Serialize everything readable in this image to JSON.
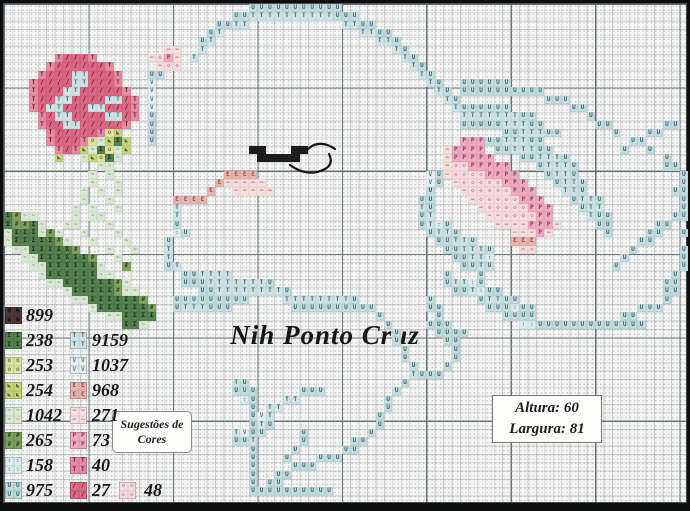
{
  "meta": {
    "kind": "cross-stitch-pattern",
    "grid_columns": 81,
    "grid_rows": 60
  },
  "watermark": {
    "text": "Nih Ponto Cruz"
  },
  "suggestion_box": {
    "line1": "Sugestões de",
    "line2": "Cores"
  },
  "size_box": {
    "altura_label": "Altura:",
    "altura_value": "60",
    "largura_label": "Largura:",
    "largura_value": "81"
  },
  "legend": {
    "left": [
      {
        "code": "899",
        "char": "M"
      },
      {
        "code": "238",
        "char": "D"
      },
      {
        "code": "253",
        "char": "l"
      },
      {
        "code": "254",
        "char": "y"
      },
      {
        "code": "1042",
        "char": "g"
      },
      {
        "code": "265",
        "char": "G"
      },
      {
        "code": "158",
        "char": ":"
      },
      {
        "code": "975",
        "char": "U"
      }
    ],
    "right": [
      {
        "code": "9159",
        "char": "T"
      },
      {
        "code": "1037",
        "char": "V"
      },
      {
        "code": "968",
        "char": "E"
      },
      {
        "code": "271",
        "char": "-"
      },
      {
        "code": "73",
        "char": "P"
      },
      {
        "code": "40",
        "char": "r"
      },
      {
        "code": "27",
        "char": "R"
      }
    ],
    "extra": {
      "code": "48",
      "char": "d"
    }
  },
  "pattern": {
    "palette": {
      "R": {
        "code": "27",
        "color": "#dd6785",
        "symbol": "/",
        "symbol_color": "#5a1a28"
      },
      "r": {
        "code": "40",
        "color": "#e78aa4",
        "symbol": "T",
        "symbol_color": "#6a2035"
      },
      "P": {
        "code": "73",
        "color": "#f0a9c0",
        "symbol": "P",
        "symbol_color": "#8a3a55"
      },
      "d": {
        "code": "48",
        "color": "#f6dbe0",
        "symbol": "◇",
        "symbol_color": "#b06a80"
      },
      "-": {
        "code": "271",
        "color": "#f5dede",
        "symbol": "–",
        "symbol_color": "#a06868"
      },
      "E": {
        "code": "968",
        "color": "#e9b3ae",
        "symbol": "Ɛ",
        "symbol_color": "#8a4a45"
      },
      "M": {
        "code": "899",
        "color": "#4d3838",
        "symbol": "▦",
        "symbol_color": "#1f1414"
      },
      "D": {
        "code": "238",
        "color": "#55814f",
        "symbol": "Σ",
        "symbol_color": "#17301c"
      },
      "G": {
        "code": "265",
        "color": "#7fa05f",
        "symbol": "#",
        "symbol_color": "#2c431f"
      },
      "y": {
        "code": "254",
        "color": "#c6d37b",
        "symbol": "◣",
        "symbol_color": "#55602a"
      },
      "l": {
        "code": "253",
        "color": "#dde3a3",
        "symbol": "o",
        "symbol_color": "#707b38"
      },
      "g": {
        "code": "1042",
        "color": "#d9e7d4",
        "symbol": "~",
        "symbol_color": "#6d8f6d"
      },
      "U": {
        "code": "975",
        "color": "#c2dbdd",
        "symbol": "U",
        "symbol_color": "#39656e"
      },
      "T": {
        "code": "9159",
        "color": "#cfe3e4",
        "symbol": "T",
        "symbol_color": "#39656e"
      },
      "V": {
        "code": "1037",
        "color": "#e6eff0",
        "symbol": "V",
        "symbol_color": "#5a7d85"
      },
      ":": {
        "code": "158",
        "color": "#dcebec",
        "symbol": ":",
        "symbol_color": "#6a8f96"
      },
      "B": {
        "code": "black",
        "color": "#1c1c1c",
        "symbol": "",
        "symbol_color": "#000000"
      }
    },
    "rows": [
      ".............................UUUUUUUUUUU.........................................",
      "...........................UUTTTTTTTTTTUUU.......................................",
      ".........................UUTT...........TTUU.....................................",
      "........................UT................TTUU...................................",
      ".......................UT...................TTU..................................",
      "...................--..T......................TU.................................",
      "......rRRRr......-dP-.T........................TU................................",
      ".....rRRRRRRr.....-dd...........................TU...............................",
      "....rRRRTTRRRr...UU..............................TU..............................",
      "...rRRRRTTRRRr...V................................TU..UUUUUU.....................",
      "...rRRRTTRRRRRr..V.................................TU.UUUUUUUUUU.................",
      "...rRRTTRRRRTTRr.V..................................TU..........UUU..............",
      "...rRTTRRRTTRRRr.V...................................TUUUUUU.......UU............",
      "....rRTTRRRRTTRr.U....................................TTTTTTTUU......U...........",
      "....rRRTTRRRRRr..U....................................UUUUUTTTUU......UU......UU.",
      ".....rRRRRRrly...U.........................................UUTTTUU......U...UU...",
      ".....rRRRrlgyDy..U....................................PPPUUTTTUU..........UU.....",
      "......rRrygDlgy..............BB...BB................-PPPP.UUTTTUU........U..U....",
      "......y..gylDg................BBBBB.................-PPPPP...UUTTTU...........U..",
      "...........gg.......................................-ddPPPPP...UTTTU..........UU.",
      "..........g.g.............EEEE....................VU-ddddPPPP...UTTU............U",
      "..........g..g...........E-----...................VU.-dddddPPP...UTTU...........U",
      ".........g.g.g..........E..-----..................U...-dddddPPP...TTU..........UU",
      ".........g..g.......EEEE.........................UU....-dddddPPP...UTTU.........U",
      "........g.g..g......T............................TU.....-dddddPPP...UTT.........U",
      "DGgg....g.gg........T............................UT......--ddddPP....TUU.......UU",
      "DGGDg..gg...g.......U............................UT:U.....----PPP-....UU.....UU..",
      "gDDDgGg..g...g......:U............................UTTU......---P-......U....UU..U",
      "gDDDDDGg..g...g....U...............................UUTTU....EEE............UU....",
      ".ggDDDDDG...g..g...T................................UUTTTU...--...........U.....U",
      "..ggDDDDDDG..g.....T.................................UUTT:...............U......U",
      "...ggDDDDDDg..G....UT.................................UUTU..............U.......U",
      "....gDDDDDDgg........UUTTTT.........................U...U......................U.",
      ".....ggDDDDDDGg......UUUTTTTTTTU....................UTT:U.....................UU.",
      ".......gDDDDDGgg.......UUTTTTTTTTU...................UUT:UU...................UU.",
      "........ggDDDDDDG...UUUUUUUUU....TTTTTTTTU........U.....UTTUU.................U..",
      "..........gDDDDDDG..UTTTUUU.......UUUUUUUUUU......UU.....UUU:UU............UUU...",
      "............ggDDDD..........................U......U.......UUUU..........UU......",
      "..............DDg............................U....UUU........::UUUUUUUUUUUUU.....",
      "..............................................U....UUUU..........................",
      "..............................................U.....UU...........................",
      "...............................................U.....U...........................",
      "...............................................U.....U...........................",
      "................................................U...U............................",
      "................................................TUUU.............................",
      "...........................TU..................U.................................",
      "...........................UUU.....UUU........U..................................",
      "............................:U...TT..........U...................................",
      ".............................U.TT............U...................................",
      ".............................UVT............U....................................",
      ".............................UTU............U....................................",
      "...........................TVUU....U.......U.....................................",
      "...........................UUT.....U.....UU......................................",
      ".............................U....U.....UU.......................................",
      ".............................U...U...UUU.........................................",
      ".............................U....UUU............................................",
      ".............................U..UU...............................................",
      ".............................U.UU................................................",
      ".............................UUUUUUUUUU..........................................",
      "................................................................................."
    ]
  },
  "backstitch": {
    "color": "#151515",
    "paths": [
      "M303,146 Q315,134 331,145",
      "M286,161 Q304,174 321,165 Q330,160 325,150"
    ]
  }
}
